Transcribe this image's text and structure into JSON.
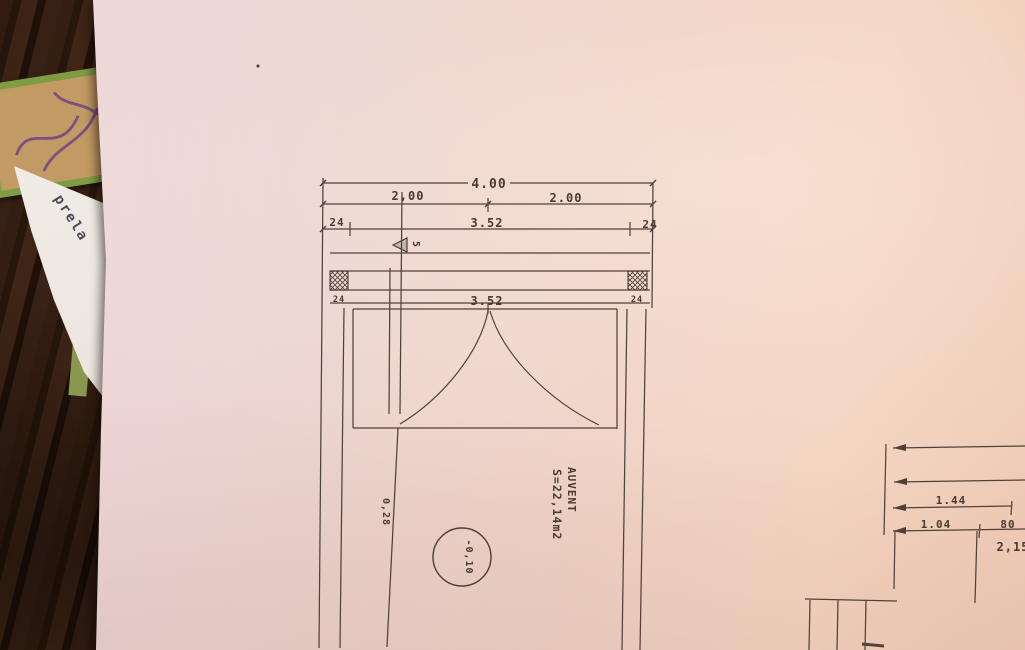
{
  "scene": {
    "under_paper_text": "prela"
  },
  "plan": {
    "dim400": "4.00",
    "dim200_left": "2,00",
    "dim200_right": "2.00",
    "dim24_left": "24",
    "dim352_top": "3.52",
    "dim24_right": "24",
    "dim352_door": "3.52",
    "post24_left": "24",
    "post24_right": "24",
    "datum_label": "5",
    "room_name": "AUVENT",
    "room_area": "S=22,14m2",
    "level_mark": "-0,10",
    "dim028": "0,28"
  },
  "detail": {
    "dim144": "1.44",
    "dim104": "1.04",
    "dim80": "80",
    "dim215": "2,15"
  },
  "colors": {
    "ink": "#4d3e36",
    "paper_pink": "#eed3c4",
    "notebook_green": "#7f9c45",
    "table_wood": "#4c2b1a"
  }
}
